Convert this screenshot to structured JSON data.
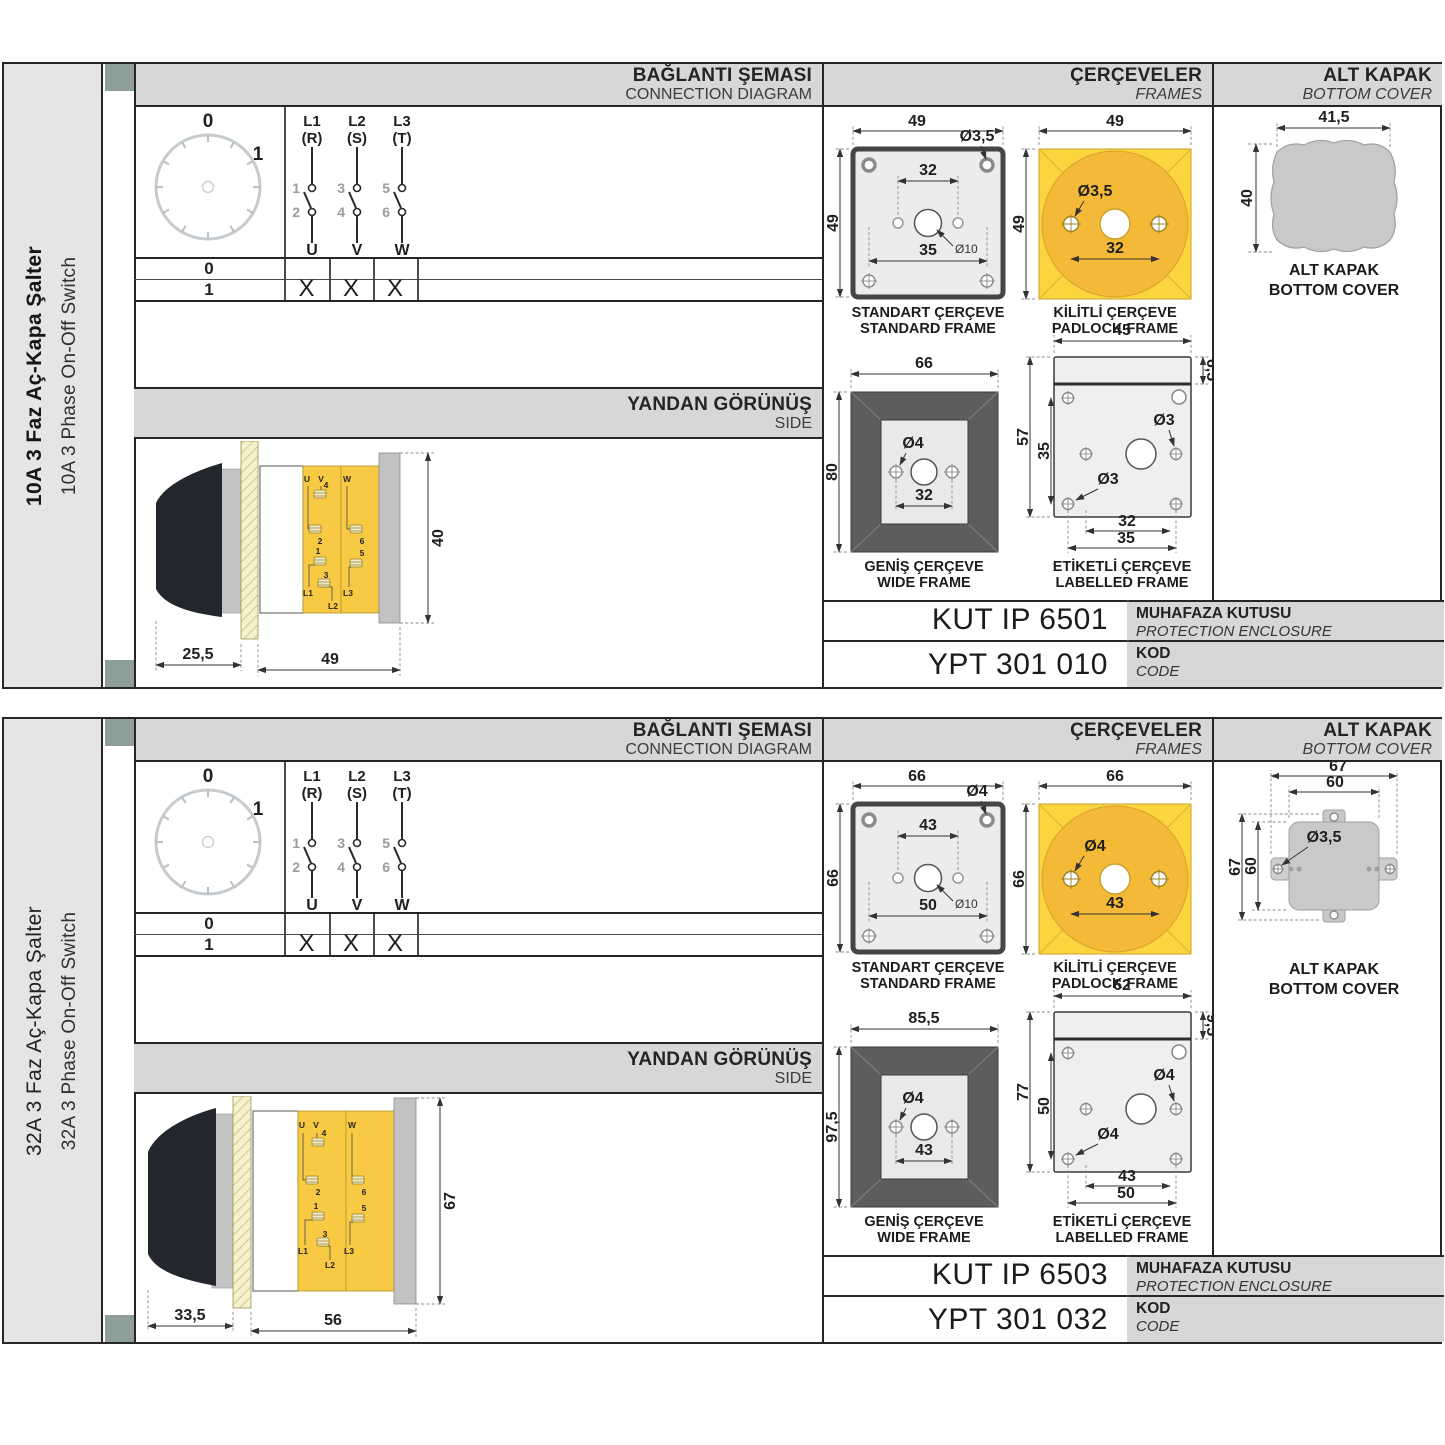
{
  "shared": {
    "headers": {
      "connection_tr": "BAĞLANTI ŞEMASI",
      "connection_en": "CONNECTION DIAGRAM",
      "frames_tr": "ÇERÇEVELER",
      "frames_en": "FRAMES",
      "cover_tr": "ALT KAPAK",
      "cover_en": "BOTTOM COVER",
      "side_tr": "YANDAN GÖRÜNÜŞ",
      "side_en": "SIDE"
    },
    "dial": {
      "pos0": "0",
      "pos1": "1"
    },
    "phases": [
      {
        "line": "L1",
        "phase": "(R)",
        "top": "1",
        "bottom": "2",
        "out": "U"
      },
      {
        "line": "L2",
        "phase": "(S)",
        "top": "3",
        "bottom": "4",
        "out": "V"
      },
      {
        "line": "L3",
        "phase": "(T)",
        "top": "5",
        "bottom": "6",
        "out": "W"
      }
    ],
    "table": {
      "row0": "0",
      "row1": "1",
      "mark": "X"
    },
    "captions": {
      "standard_tr": "STANDART ÇERÇEVE",
      "standard_en": "STANDARD FRAME",
      "padlock_tr": "KİLİTLİ ÇERÇEVE",
      "padlock_en": "PADLOCK FRAME",
      "wide_tr": "GENİŞ ÇERÇEVE",
      "wide_en": "WIDE FRAME",
      "labelled_tr": "ETİKETLİ ÇERÇEVE",
      "labelled_en": "LABELLED FRAME",
      "cover_tr": "ALT KAPAK",
      "cover_en": "BOTTOM COVER"
    },
    "codes_labels": {
      "enclosure_tr": "MUHAFAZA KUTUSU",
      "enclosure_en": "PROTECTION ENCLOSURE",
      "code_tr": "KOD",
      "code_en": "CODE"
    },
    "terminals": {
      "u": "U",
      "v": "V",
      "w": "W",
      "n1": "1",
      "n2": "2",
      "n3": "3",
      "n4": "4",
      "n5": "5",
      "n6": "6",
      "l1": "L1",
      "l2": "L2",
      "l3": "L3"
    },
    "colors": {
      "accent_yellow": "#fcd53e",
      "circle_orange": "#f4ba37",
      "header_gray": "#d7d7d7",
      "tab_square": "#8e9e9b"
    }
  },
  "panels": [
    {
      "title_tr": "10A 3 Faz Aç-Kapa Şalter",
      "title_en": "10A 3 Phase On-Off Switch",
      "side": {
        "depth": "25,5",
        "width": "49",
        "height": "40"
      },
      "standard": {
        "w": "49",
        "h": "49",
        "hole": "Ø3,5",
        "upper": "32",
        "center": "Ø10",
        "lower": "35"
      },
      "padlock": {
        "w": "49",
        "h": "49",
        "hole": "Ø3,5",
        "span": "32"
      },
      "wide": {
        "w": "66",
        "h": "80",
        "hole": "Ø4",
        "span": "32"
      },
      "labelled": {
        "w": "45",
        "h": "57",
        "label_h": "6,5",
        "inner_h": "35",
        "hole_right": "Ø3",
        "hole_left": "Ø3",
        "span1": "32",
        "span2": "35"
      },
      "cover": {
        "w": "41,5",
        "h": "40"
      },
      "codes": {
        "enclosure": "KUT IP 6501",
        "code": "YPT 301 010"
      }
    },
    {
      "title_tr": "32A 3 Faz Aç-Kapa Şalter",
      "title_en": "32A 3 Phase On-Off Switch",
      "side": {
        "depth": "33,5",
        "width": "56",
        "height": "67"
      },
      "standard": {
        "w": "66",
        "h": "66",
        "hole": "Ø4",
        "upper": "43",
        "center": "Ø10",
        "lower": "50"
      },
      "padlock": {
        "w": "66",
        "h": "66",
        "hole": "Ø4",
        "span": "43"
      },
      "wide": {
        "w": "85,5",
        "h": "97,5",
        "hole": "Ø4",
        "span": "43"
      },
      "labelled": {
        "w": "62",
        "h": "77",
        "label_h": "9,5",
        "inner_h": "50",
        "hole_right": "Ø4",
        "hole_left": "Ø4",
        "span1": "43",
        "span2": "50"
      },
      "cover": {
        "w1": "67",
        "w2": "60",
        "h1": "67",
        "h2": "60",
        "hole": "Ø3,5"
      },
      "codes": {
        "enclosure": "KUT IP 6503",
        "code": "YPT 301 032"
      }
    }
  ]
}
